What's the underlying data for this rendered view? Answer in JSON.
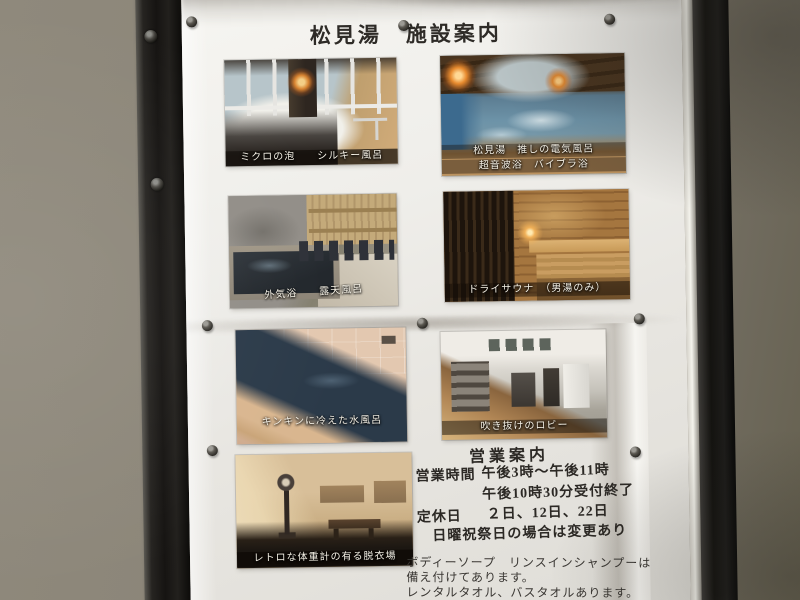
{
  "poster": {
    "title": "松見湯　施設案内",
    "photos": [
      {
        "name": "silky-bath",
        "caption": "ミクロの泡　　シルキー風呂"
      },
      {
        "name": "electric-bath",
        "caption_line1": "松見湯　推しの電気風呂",
        "caption_line2": "超音波浴　バイブラ浴"
      },
      {
        "name": "open-air-bath",
        "caption": "外気浴　　露天風呂"
      },
      {
        "name": "dry-sauna",
        "caption": "ドライサウナ　（男湯のみ）"
      },
      {
        "name": "cold-bath",
        "caption": "キンキンに冷えた水風呂"
      },
      {
        "name": "lobby",
        "caption": "吹き抜けのロビー"
      },
      {
        "name": "dressing-room",
        "caption": "レトロな体重計の有る脱衣場"
      }
    ],
    "business_info": {
      "heading": "営業案内",
      "hours_label": "営業時間",
      "hours_value": "午後3時〜午後11時",
      "hours_note": "午後10時30分受付終了",
      "closed_label": "定休日",
      "closed_value": "２日、12日、22日",
      "closed_note": "日曜祝祭日の場合は変更あり"
    },
    "amenities": {
      "line1": "ボディーソープ　リンスインシャンプーは",
      "line2": "備え付けてあります。",
      "line3": "レンタルタオル、バスタオルあります。"
    },
    "hardware": {
      "push_pin_count": 8,
      "screw_count": 2
    }
  },
  "colors": {
    "wall": "#8b8578",
    "frame": "#141310",
    "paper": "#efeeea",
    "ink": "#2c2925",
    "caption_text": "#f4f0e5"
  }
}
